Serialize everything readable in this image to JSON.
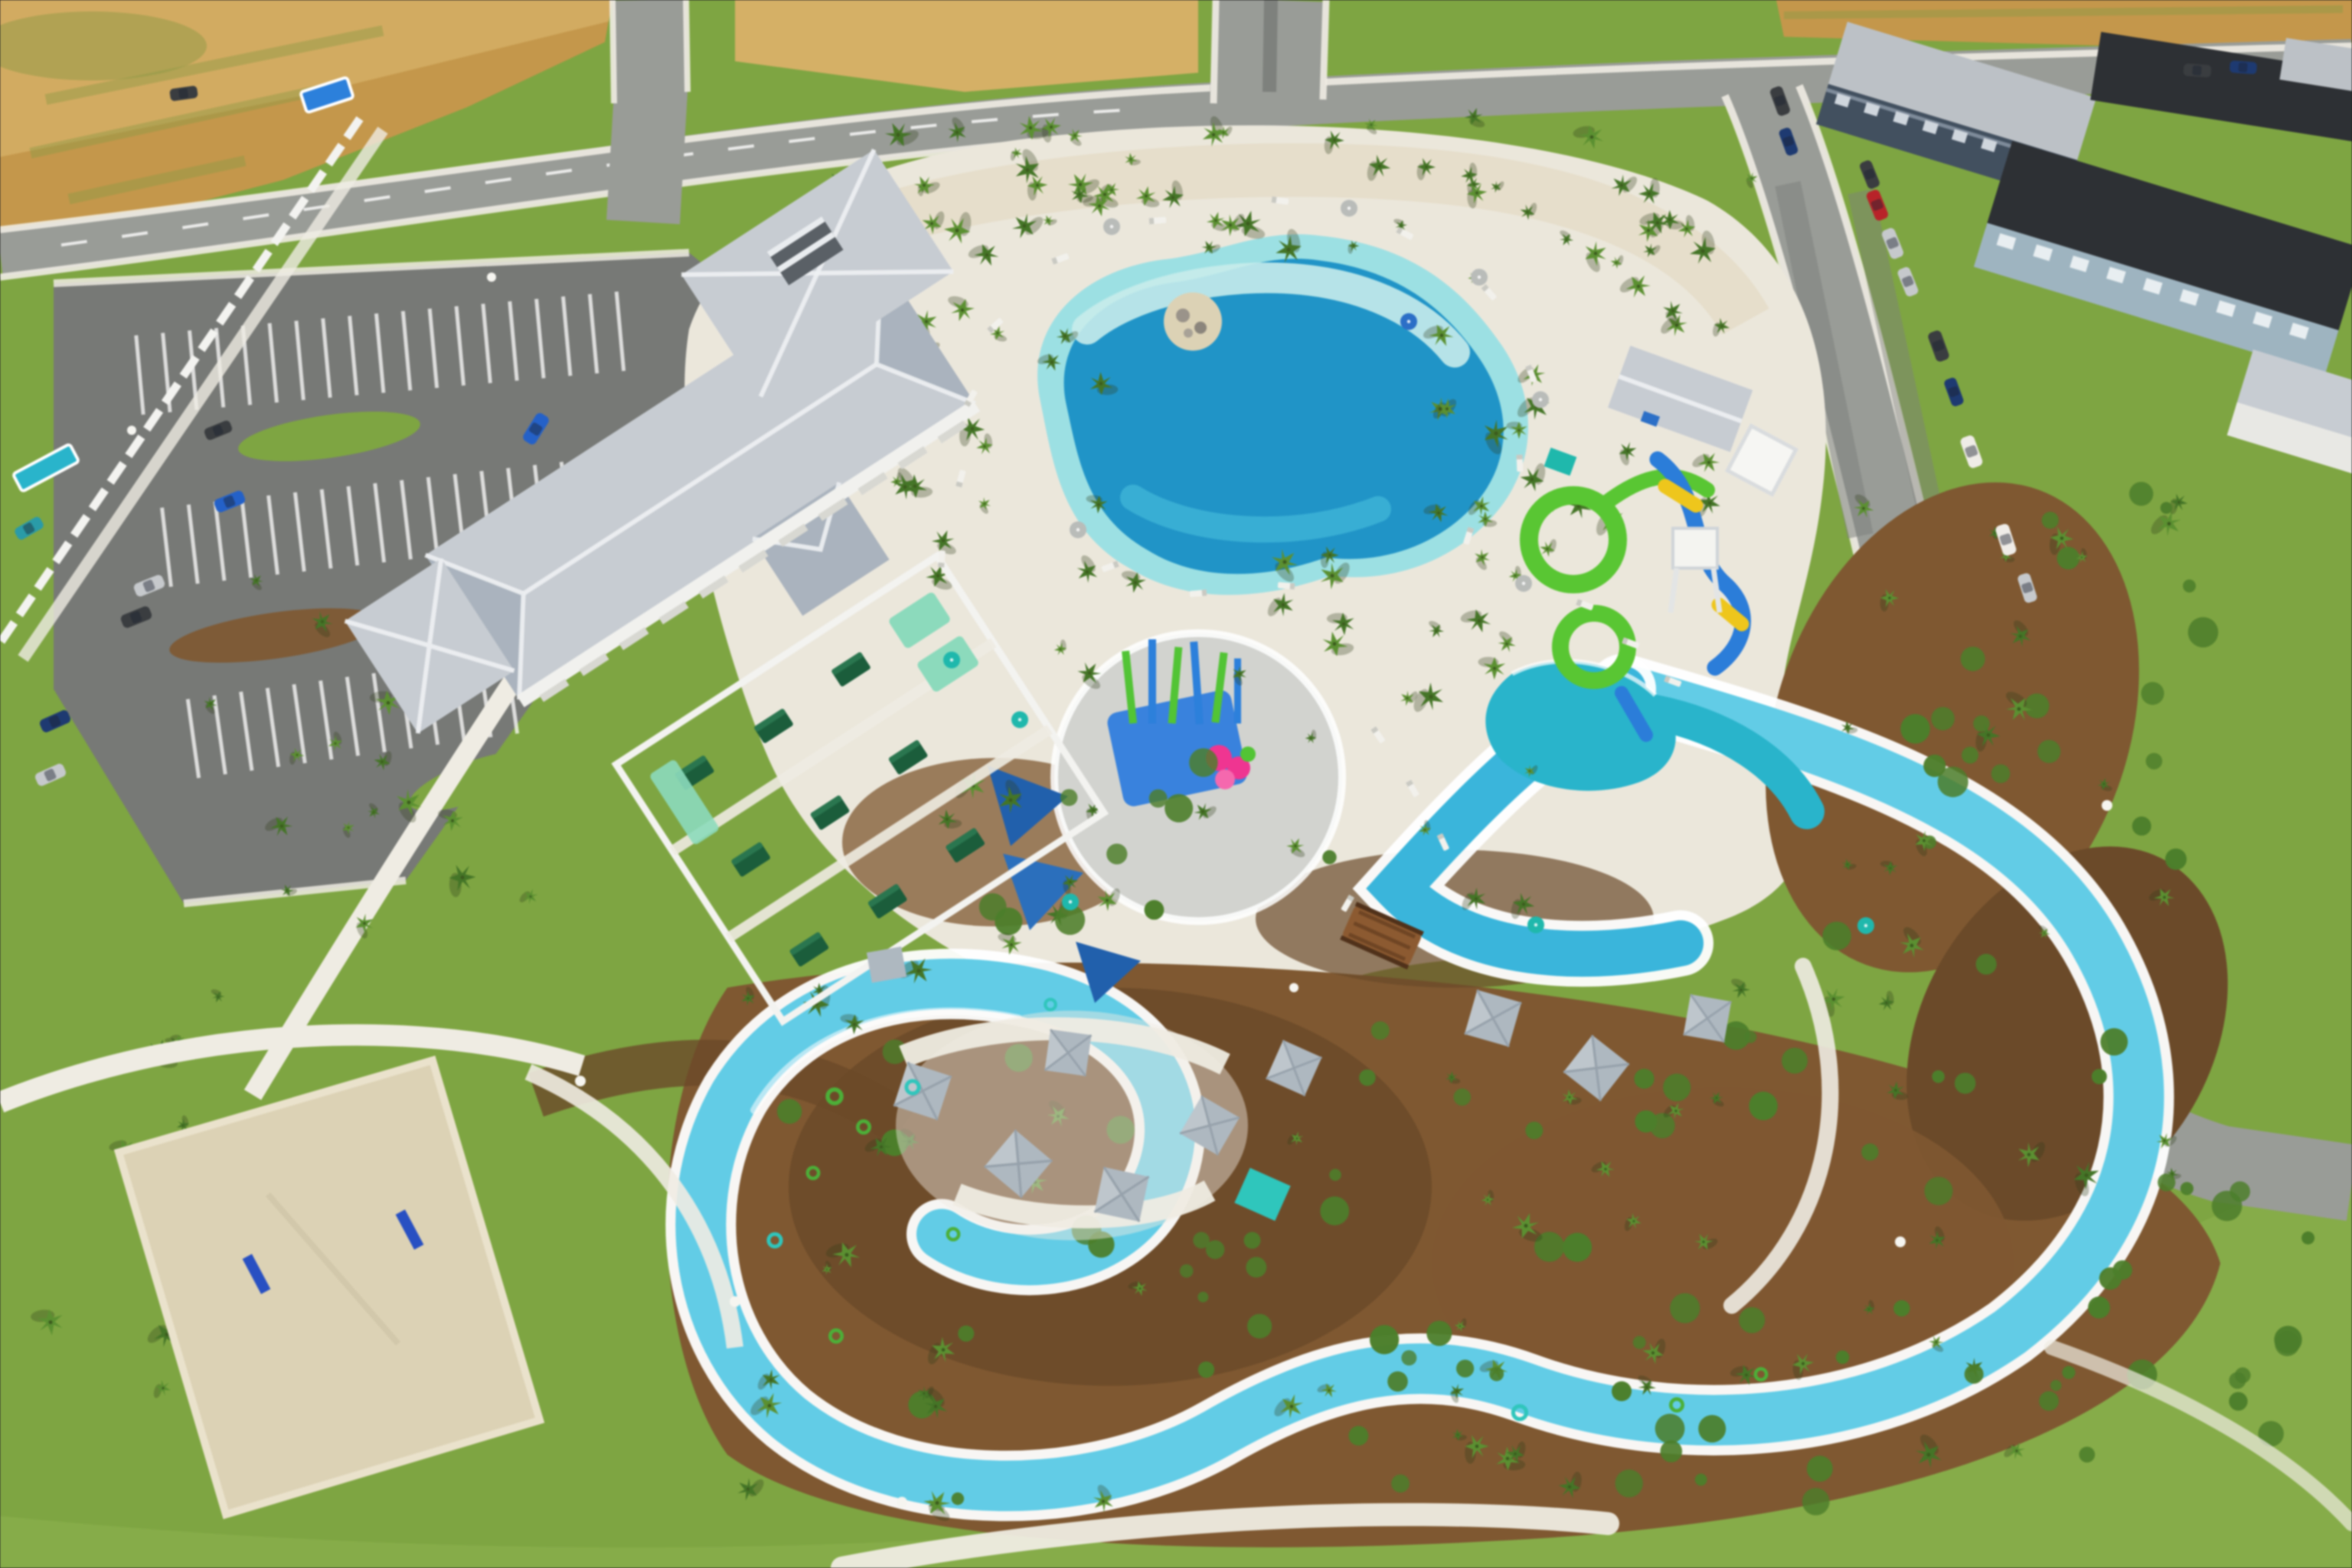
{
  "meta": {
    "description": "Aerial drone photograph of a new resort-style community amenity water park: lagoon pool, splash pad, water slides, winding lazy river with float tubes, clubhouse with gray metal roofs, cabanas, sand volleyball court, parking lots, perimeter roads and townhomes under a sunny sky",
    "view": "oblique-aerial",
    "visible_text": ""
  },
  "scene": {
    "features": [
      "clubhouse-building",
      "lagoon-pool",
      "beach-entry-island",
      "splash-pad",
      "water-slide-tower",
      "slide-splash-pool",
      "lazy-river",
      "float-tubes",
      "cabanas",
      "daybed-yard",
      "sand-volleyball-court",
      "palm-trees",
      "mulch-landscaping",
      "pool-deck",
      "parking-lot",
      "perimeter-roads",
      "townhomes",
      "parked-cars",
      "street-lamps",
      "white-perimeter-fence",
      "dry-farm-field",
      "shade-umbrellas",
      "lounge-chairs",
      "wooden-bridge"
    ]
  },
  "colors": {
    "grass": "#7fa446",
    "grassLight": "#90b154",
    "field": "#c2974f",
    "fieldLight": "#d3b06a",
    "fieldOlive": "#8f9a4a",
    "road": "#999c97",
    "roadDark": "#7e817d",
    "parking": "#777976",
    "sidewalk": "#efece3",
    "deck": "#ebe7dc",
    "deckSand": "#e2d8c2",
    "sand": "#dcd2b6",
    "lagoonDeep": "#2593c4",
    "lagoonMid": "#43b4d4",
    "lagoonShallow": "#9fdfe2",
    "lagoonBeach": "#c9eceb",
    "river": "#66cbe4",
    "riverDeep": "#3fb4d8",
    "poolTeal": "#2eb3c9",
    "splashPad": "#d2d3cf",
    "splashMat": "#3c82d8",
    "featGreen": "#56c23a",
    "featBlue": "#2f7fd6",
    "featPink": "#e8378f",
    "slideGreen": "#5dc438",
    "slideBlue": "#2e7cd4",
    "slideYellow": "#ecc624",
    "roofGray": "#c7ccd2",
    "roofRidge": "#eef1f3",
    "roofShade": "#aab3bd",
    "wall": "#f1f1ee",
    "cabanaRoof": "#aeb8c0",
    "mulch": "#7d5833",
    "mulchDark": "#6a4a2b",
    "palm": "#5d8f35",
    "palmDark": "#46742a",
    "shrub": "#4e7d2e",
    "fence": "#f3f3f0",
    "umbTeal": "#25b6ab",
    "umbGray": "#b9bcb9",
    "umbBlue": "#2f6fc2",
    "daybedGreen": "#1d5c3c",
    "daybedMint": "#8fd9bd",
    "bridge": "#8a5a33",
    "roofSilver": "#bcc1c6",
    "roofBlack": "#2d3034",
    "facadeBlue": "#9fb4bf",
    "facadeDark": "#43505e",
    "carBlue": "#2761c3",
    "carTeal": "#2e9aa6",
    "carRed": "#b2252a",
    "carSilver": "#c6c9cc",
    "carWhite": "#efece7",
    "carDark": "#3a3d40",
    "carNavy": "#1f3a6e",
    "lamp": "#f6f5f0",
    "postBlue": "#2a50bd",
    "tubeGreen": "#4fae3c",
    "tubeTeal": "#35c4bb"
  }
}
